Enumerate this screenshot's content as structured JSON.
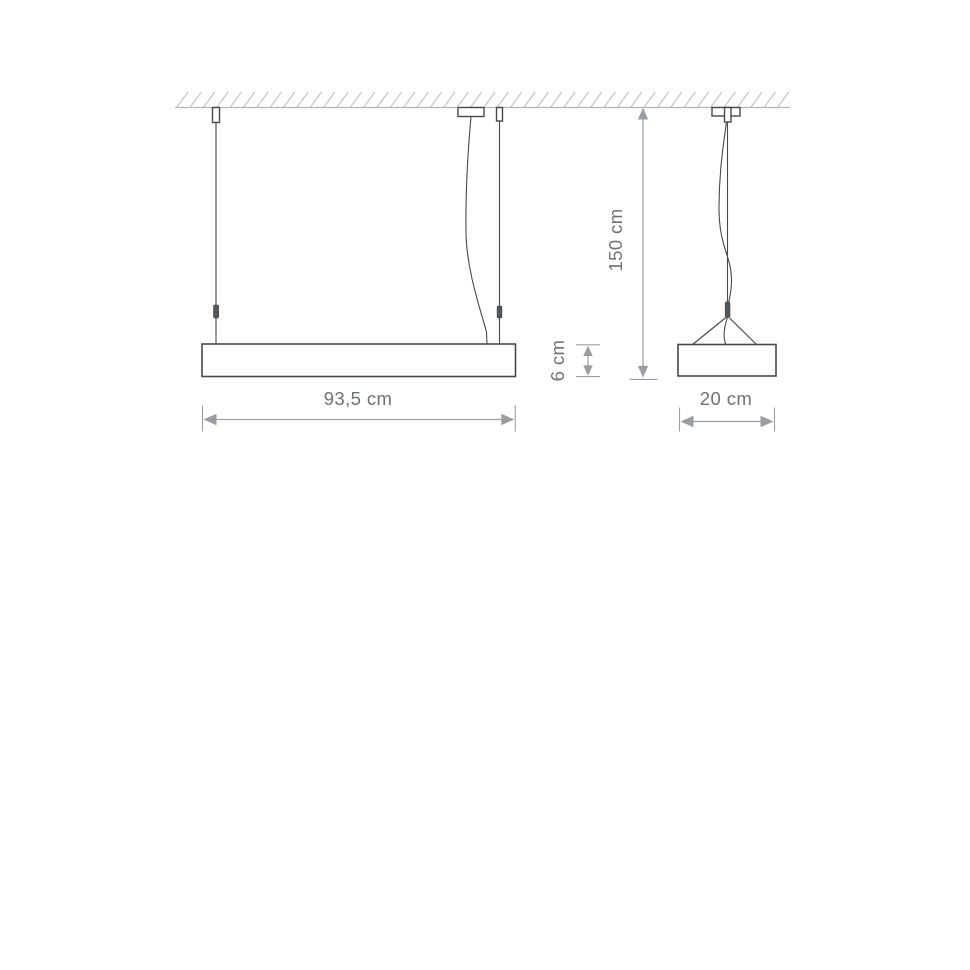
{
  "colors": {
    "outline": "#46494c",
    "fitting": "#54575a",
    "dimension": "#9b9ea1",
    "text": "#6d7174",
    "hatch": "#b4b6b8",
    "background": "#ffffff"
  },
  "diagram": {
    "dimensions": {
      "width": {
        "label": "93,5 cm"
      },
      "height": {
        "label": "6 cm"
      },
      "suspension": {
        "label": "150 cm"
      },
      "depth": {
        "label": "20 cm"
      }
    }
  }
}
